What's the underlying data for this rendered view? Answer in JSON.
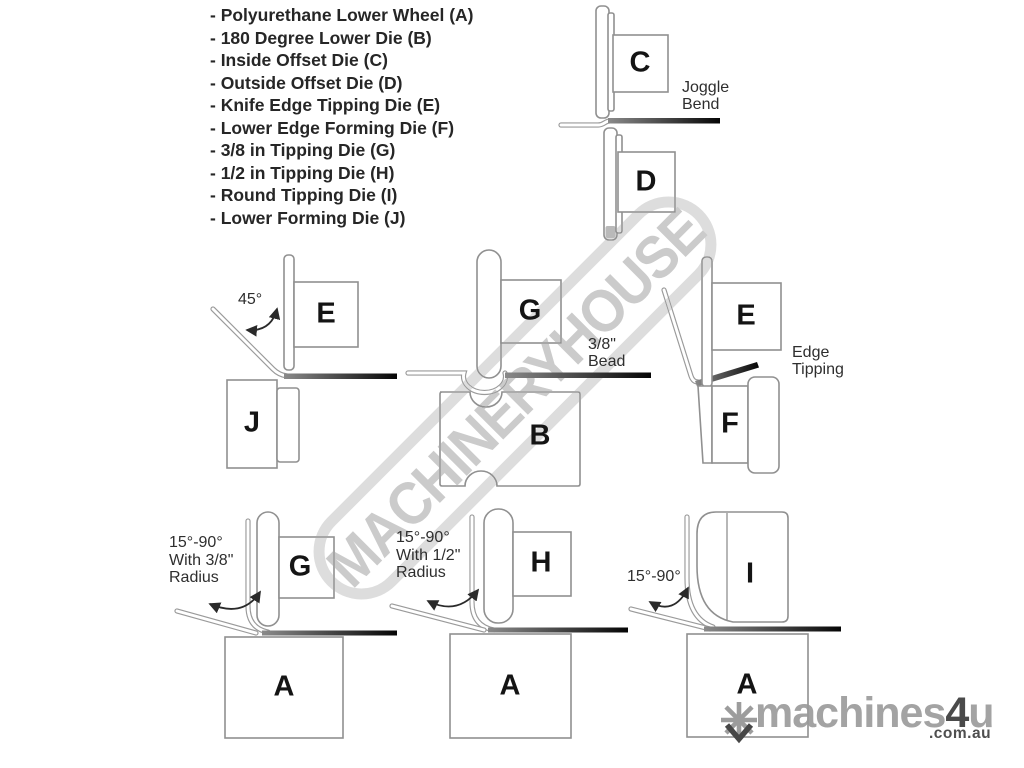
{
  "parts_list": {
    "items": [
      "- Polyurethane Lower Wheel (A)",
      "- 180 Degree Lower Die (B)",
      "- Inside Offset Die (C)",
      "- Outside Offset Die (D)",
      "- Knife Edge Tipping Die (E)",
      "- Lower Edge Forming Die (F)",
      "- 3/8 in Tipping Die (G)",
      "- 1/2 in Tipping Die (H)",
      "- Round Tipping Die (I)",
      "- Lower Forming Die (J)"
    ]
  },
  "annotations": {
    "joggle": [
      "Joggle",
      "Bend"
    ],
    "bead": [
      "3/8\"",
      "Bead"
    ],
    "edge_tipping": [
      "Edge",
      "Tipping"
    ],
    "angle_45": "45°",
    "tipping_38": [
      "15°-90°",
      "With 3/8\"",
      "Radius"
    ],
    "tipping_12": [
      "15°-90°",
      "With 1/2\"",
      "Radius"
    ],
    "tipping_round": "15°-90°"
  },
  "die_labels": {
    "c": "C",
    "d": "D",
    "e_knife": "E",
    "j": "J",
    "g_bead": "G",
    "b": "B",
    "e_tip": "E",
    "f": "F",
    "g_38": "G",
    "h_12": "H",
    "i_round": "I",
    "a_1": "A",
    "a_2": "A",
    "a_3": "A"
  },
  "watermark": {
    "text": "MACHINERYHOUSE"
  },
  "logo": {
    "brand": "machines",
    "four": "4",
    "u": "u",
    "domain": ".com.au"
  },
  "theme": {
    "outline": "#909090",
    "ink": "#141414",
    "note": "#2e2e2e",
    "watermark-text": "#c8c8c8",
    "watermark-ring": "#dbdbdb",
    "logo-gray": "#a3a3a3",
    "logo-dark": "#4a4a4a",
    "sheet-dark": "#050505"
  }
}
